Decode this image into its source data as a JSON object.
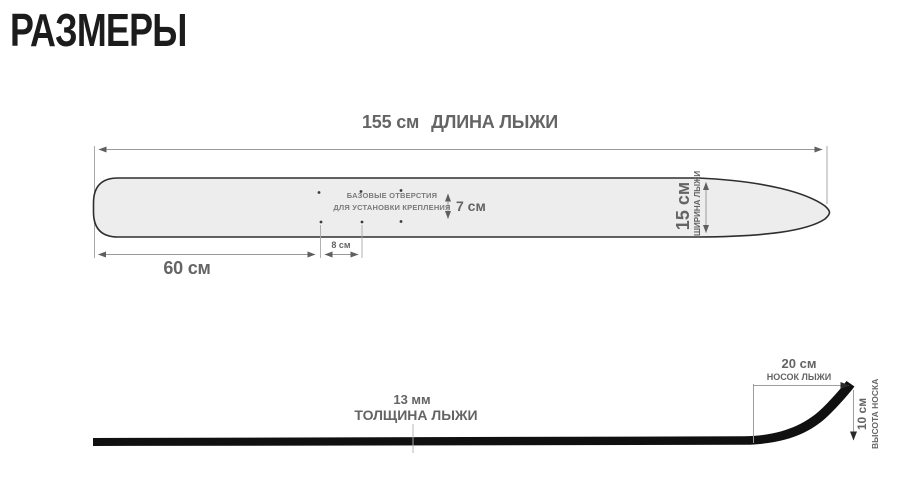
{
  "title": "РАЗМЕРЫ",
  "colors": {
    "background": "#ffffff",
    "title_text": "#1c1c1c",
    "dimension_text": "#646464",
    "dimension_line": "#9a9a9a",
    "ski_fill": "#ededed",
    "ski_outline": "#2e2e2e",
    "side_profile_fill": "#101010"
  },
  "top_view": {
    "length": {
      "value": "155 см",
      "label": "ДЛИНА ЛЫЖИ"
    },
    "width": {
      "value": "15 см",
      "label": "ШИРИНА ЛЫЖИ"
    },
    "tail_to_binding": {
      "value": "60 см"
    },
    "hole_spacing_horizontal": {
      "value": "8 см"
    },
    "hole_spacing_vertical": {
      "value": "7 см"
    },
    "holes_note": {
      "line1": "БАЗОВЫЕ ОТВЕРСТИЯ",
      "line2": "ДЛЯ УСТАНОВКИ КРЕПЛЕНИЯ"
    }
  },
  "side_view": {
    "thickness": {
      "value": "13 мм",
      "label": "ТОЛЩИНА ЛЫЖИ"
    },
    "tip_length": {
      "value": "20 см",
      "label": "НОСОК ЛЫЖИ"
    },
    "tip_height": {
      "value": "10 см",
      "label": "ВЫСОТА НОСКА"
    }
  }
}
